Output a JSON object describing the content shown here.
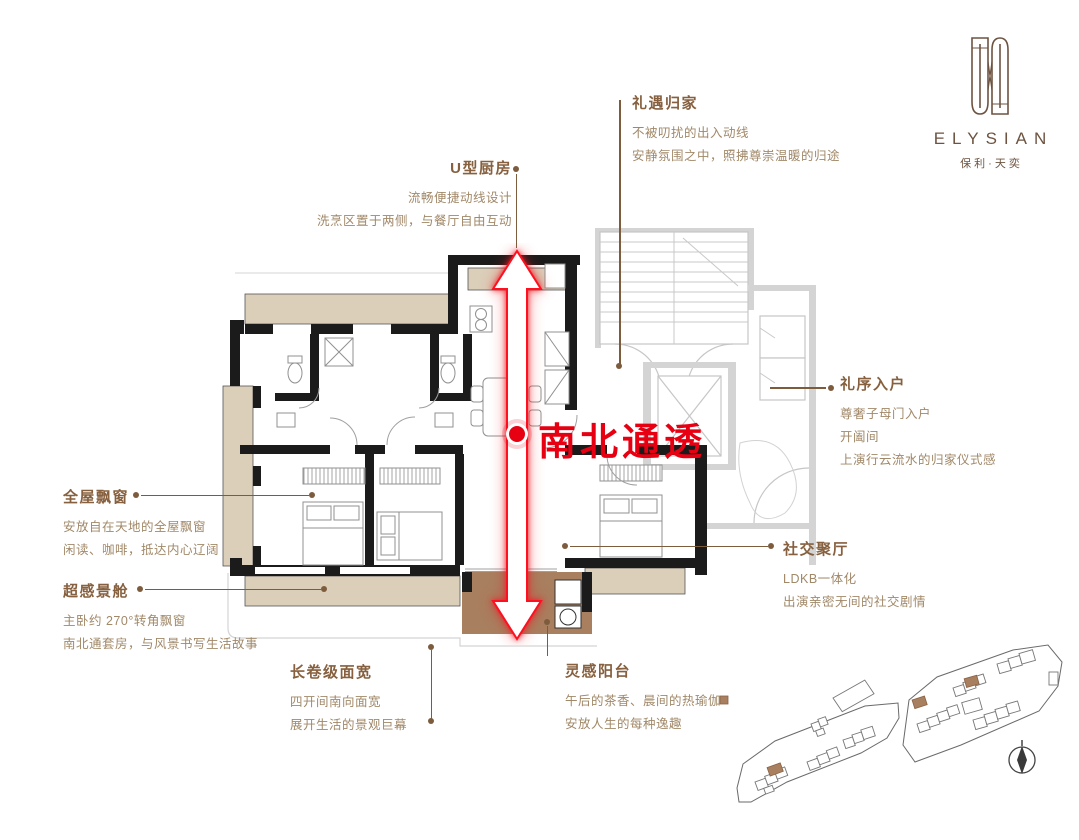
{
  "brand": {
    "name": "ELYSIAN",
    "sub": "保利·天奕"
  },
  "center_label": {
    "text": "南北通透"
  },
  "annotations": {
    "homecoming": {
      "title": "礼遇归家",
      "lines": [
        "不被叨扰的出入动线",
        "安静氛围之中，照拂尊崇温暖的归途"
      ]
    },
    "kitchen": {
      "title": "U型厨房",
      "lines": [
        "流畅便捷动线设计",
        "洗烹区置于两侧，与餐厅自由互动"
      ]
    },
    "entry": {
      "title": "礼序入户",
      "lines": [
        "尊奢子母门入户",
        "开阖间",
        "上演行云流水的归家仪式感"
      ]
    },
    "baywindow": {
      "title": "全屋飘窗",
      "lines": [
        "安放自在天地的全屋飘窗",
        "闲读、咖啡，抵达内心辽阔"
      ]
    },
    "viewcabin": {
      "title": "超感景舱",
      "lines": [
        "主卧约 270°转角飘窗",
        "南北通套房，与风景书写生活故事"
      ]
    },
    "social": {
      "title": "社交聚厅",
      "lines": [
        "LDKB一体化",
        "出演亲密无间的社交剧情"
      ]
    },
    "span": {
      "title": "长卷级面宽",
      "lines": [
        "四开间南向面宽",
        "展开生活的景观巨幕"
      ]
    },
    "balcony": {
      "title": "灵感阳台",
      "lines": [
        "午后的茶香、晨间的热瑜伽",
        "安放人生的每种逸趣"
      ]
    }
  },
  "colors": {
    "accent_red": "#e60012",
    "brand_brown": "#6d5340",
    "heading_brown": "#86603f",
    "body_brown": "#a18868",
    "bay_beige": "#dbcfba",
    "balcony_brown": "#a87f5f",
    "wall_black": "#1b1b1b",
    "common_gray": "#c9c9c9"
  },
  "icons": {
    "logo_mark": "elysian-gate-mark",
    "compass": "north-compass",
    "arrow": "north-south-double-arrow"
  }
}
